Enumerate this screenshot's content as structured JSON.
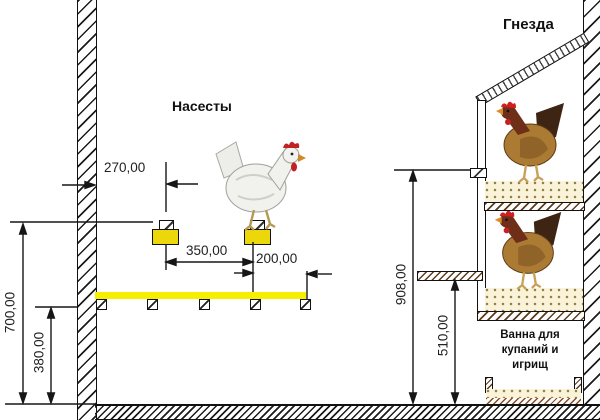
{
  "labels": {
    "roosts": "Насесты",
    "nests": "Гнезда",
    "bath_line1": "Ванна для",
    "bath_line2": "купаний и",
    "bath_line3": "игрищ"
  },
  "dimensions": {
    "wall_to_first_perch": "270,00",
    "between_perches": "350,00",
    "perch_to_platform_edge": "200,00",
    "perch_height_from_floor": "700,00",
    "platform_height_from_floor": "380,00",
    "upper_nest_height": "908,00",
    "lower_nest_height": "510,00"
  },
  "colors": {
    "platform_yellow": "#f6ee00",
    "bracket_yellow": "#ecd70b",
    "bedding_cream": "#faf3da",
    "line_black": "#1a1a1a"
  }
}
